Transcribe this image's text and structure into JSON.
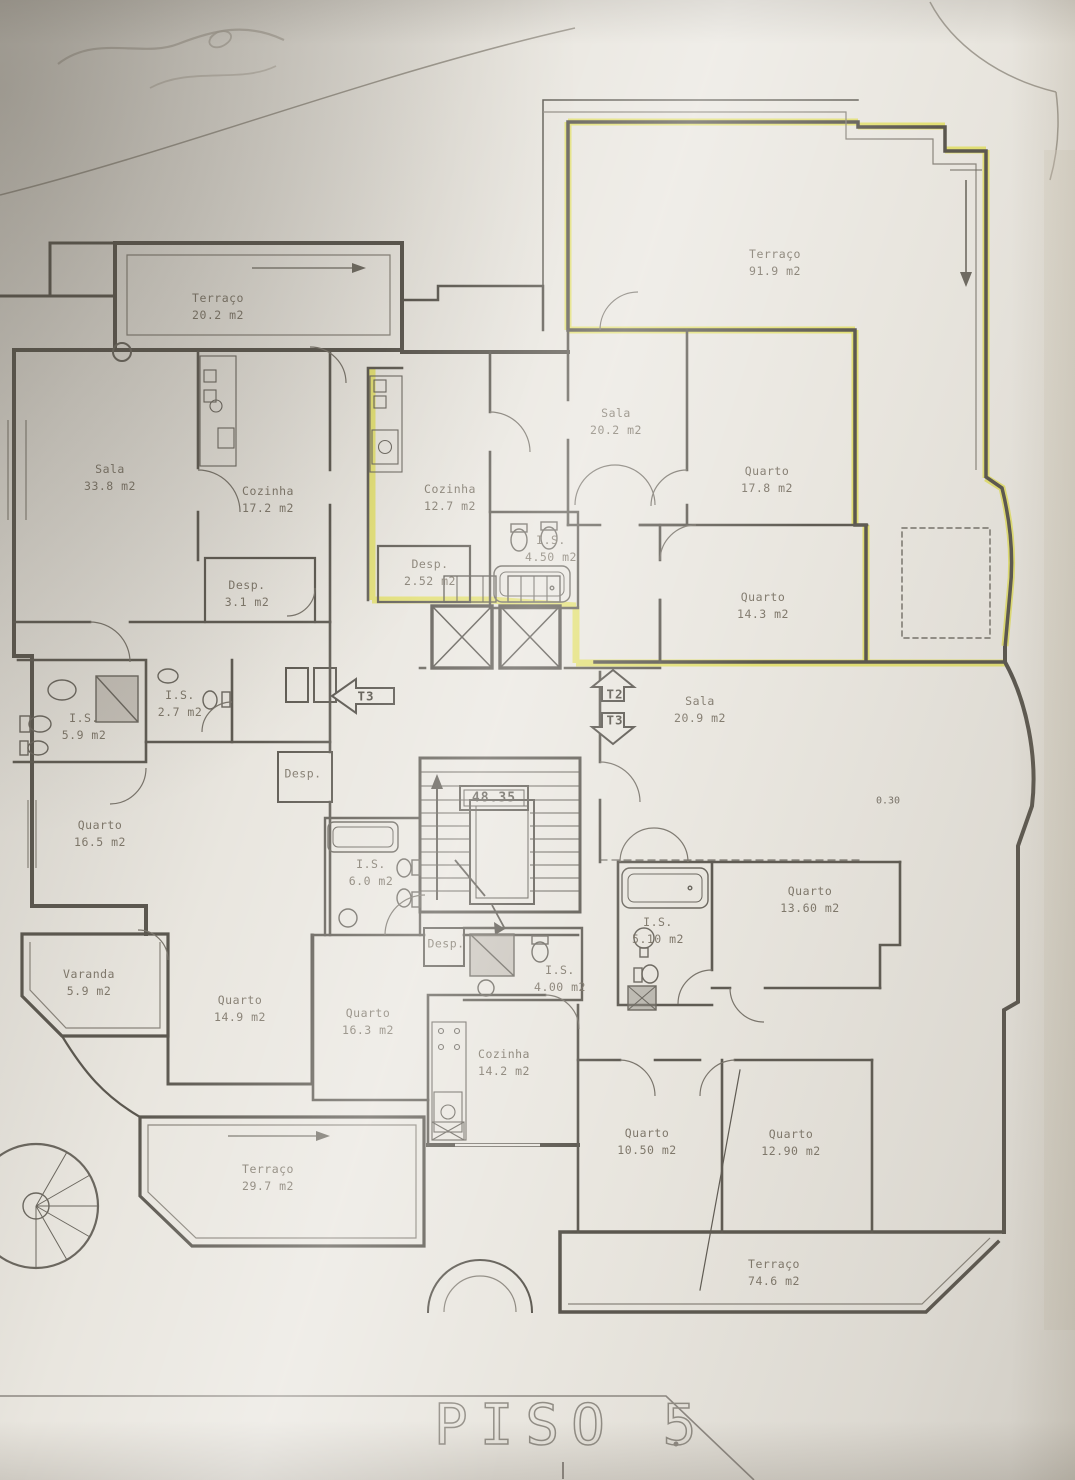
{
  "plan": {
    "title": "PISO 5",
    "level_marker": "48.35",
    "dim_label": "0.30",
    "markers": [
      {
        "label": "T3",
        "direction": "left"
      },
      {
        "label": "T2",
        "direction": "up"
      },
      {
        "label": "T3",
        "direction": "down"
      }
    ],
    "rooms": [
      {
        "name": "Terraço",
        "area": "20.2 m2"
      },
      {
        "name": "Terraço",
        "area": "91.9 m2"
      },
      {
        "name": "Sala",
        "area": "33.8 m2"
      },
      {
        "name": "Cozinha",
        "area": "17.2 m2"
      },
      {
        "name": "Desp.",
        "area": "3.1 m2"
      },
      {
        "name": "Cozinha",
        "area": "12.7 m2"
      },
      {
        "name": "Desp.",
        "area": "2.52 m2"
      },
      {
        "name": "I.S.",
        "area": "4.50 m2"
      },
      {
        "name": "Sala",
        "area": "20.2 m2"
      },
      {
        "name": "Quarto",
        "area": "17.8 m2"
      },
      {
        "name": "Quarto",
        "area": "14.3 m2"
      },
      {
        "name": "I.S.",
        "area": "5.9 m2"
      },
      {
        "name": "I.S.",
        "area": "2.7 m2"
      },
      {
        "name": "Quarto",
        "area": "16.5 m2"
      },
      {
        "name": "Desp.",
        "area": ""
      },
      {
        "name": "Sala",
        "area": "20.9 m2"
      },
      {
        "name": "I.S.",
        "area": "6.0 m2"
      },
      {
        "name": "Desp.",
        "area": ""
      },
      {
        "name": "I.S.",
        "area": "4.00 m2"
      },
      {
        "name": "Quarto",
        "area": "13.60 m2"
      },
      {
        "name": "I.S.",
        "area": "5.10 m2"
      },
      {
        "name": "Varanda",
        "area": "5.9 m2"
      },
      {
        "name": "Quarto",
        "area": "14.9 m2"
      },
      {
        "name": "Quarto",
        "area": "16.3 m2"
      },
      {
        "name": "Cozinha",
        "area": "14.2 m2"
      },
      {
        "name": "Quarto",
        "area": "10.50 m2"
      },
      {
        "name": "Quarto",
        "area": "12.90 m2"
      },
      {
        "name": "Terraço",
        "area": "29.7 m2"
      },
      {
        "name": "Terraço",
        "area": "74.6 m2"
      }
    ],
    "colors": {
      "highlight": "#e2de6e",
      "wall": "#5b574f",
      "paper": "#e9e6df"
    }
  }
}
